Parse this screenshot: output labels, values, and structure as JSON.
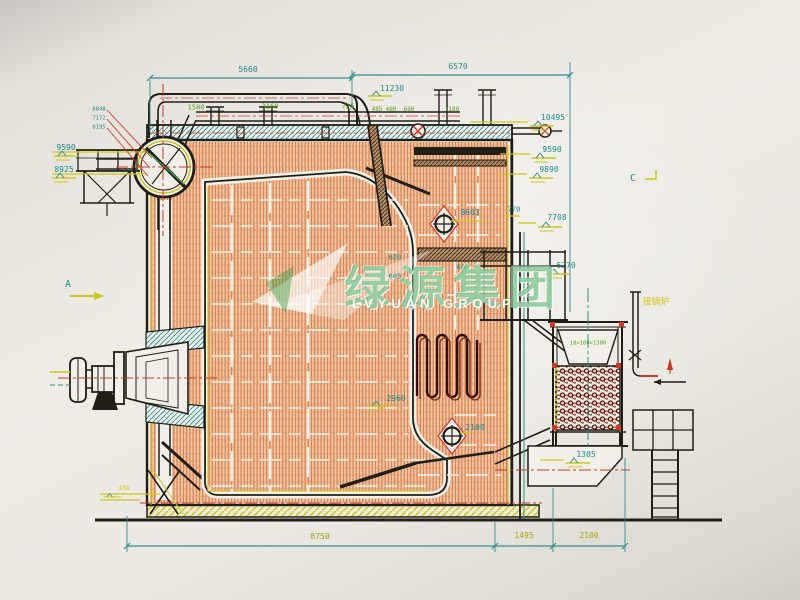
{
  "colors": {
    "paper": "#e9e6e0",
    "ink": "#211e16",
    "teal": "#1f8c8c",
    "green": "#55a11f",
    "yellow": "#cfc51e",
    "olive": "#a49f16",
    "red": "#cc3a28",
    "hatch_orange": "#cf6d3a",
    "dark_red_coil": "#5a140b",
    "watermark_green": "#2fa14b"
  },
  "watermark": {
    "cn": "绿源集团",
    "en": "LVYUAN GROUP"
  },
  "annotations": [
    {
      "id": "dim-5660",
      "text": "5660",
      "x": 248,
      "y": 70,
      "cls": "teal"
    },
    {
      "id": "dim-6570",
      "text": "6570",
      "x": 458,
      "y": 67,
      "cls": "teal"
    },
    {
      "id": "elev-11230",
      "text": "11230",
      "x": 392,
      "y": 89,
      "cls": "teal"
    },
    {
      "id": "dim-1580",
      "text": "1580",
      "x": 196,
      "y": 108,
      "cls": "green"
    },
    {
      "id": "dim-3160",
      "text": "3160",
      "x": 270,
      "y": 107,
      "cls": "green"
    },
    {
      "id": "dim-725",
      "text": "725",
      "x": 348,
      "y": 107,
      "cls": "green"
    },
    {
      "id": "dim-485",
      "text": "485",
      "x": 377,
      "y": 110,
      "cls": "green-sm"
    },
    {
      "id": "dim-480",
      "text": "480",
      "x": 391,
      "y": 110,
      "cls": "green-sm"
    },
    {
      "id": "dim-680",
      "text": "680",
      "x": 409,
      "y": 110,
      "cls": "green-sm"
    },
    {
      "id": "dim-1180",
      "text": "1180",
      "x": 452,
      "y": 110,
      "cls": "green-sm"
    },
    {
      "id": "elev-10495",
      "text": "10495",
      "x": 553,
      "y": 118,
      "cls": "teal"
    },
    {
      "id": "elev-9590-right",
      "text": "9590",
      "x": 552,
      "y": 150,
      "cls": "teal"
    },
    {
      "id": "elev-9890",
      "text": "9890",
      "x": 549,
      "y": 170,
      "cls": "teal"
    },
    {
      "id": "spec-1",
      "text": "8848",
      "x": 99,
      "y": 110,
      "cls": "tiny"
    },
    {
      "id": "spec-2",
      "text": "7172",
      "x": 99,
      "y": 119,
      "cls": "tiny"
    },
    {
      "id": "spec-3",
      "text": "8195",
      "x": 99,
      "y": 128,
      "cls": "tiny"
    },
    {
      "id": "elev-9590-left",
      "text": "9590",
      "x": 66,
      "y": 148,
      "cls": "teal"
    },
    {
      "id": "elev-8925",
      "text": "8925",
      "x": 64,
      "y": 170,
      "cls": "teal"
    },
    {
      "id": "section-a",
      "text": "A",
      "x": 68,
      "y": 285,
      "cls": "teal-lg"
    },
    {
      "id": "section-c",
      "text": "C",
      "x": 633,
      "y": 179,
      "cls": "teal-lg"
    },
    {
      "id": "elev-8603",
      "text": "8603",
      "x": 470,
      "y": 213,
      "cls": "teal"
    },
    {
      "id": "dim-770",
      "text": "770",
      "x": 514,
      "y": 210,
      "cls": "teal-sm"
    },
    {
      "id": "elev-7708",
      "text": "7708",
      "x": 557,
      "y": 218,
      "cls": "teal"
    },
    {
      "id": "elev-6270",
      "text": "6270",
      "x": 566,
      "y": 266,
      "cls": "teal"
    },
    {
      "id": "dim-620",
      "text": "620",
      "x": 395,
      "y": 258,
      "cls": "teal-sm"
    },
    {
      "id": "dim-605",
      "text": "605",
      "x": 395,
      "y": 277,
      "cls": "teal-sm"
    },
    {
      "id": "dim-600",
      "text": "600",
      "x": 463,
      "y": 268,
      "cls": "teal-sm"
    },
    {
      "id": "elev-2960",
      "text": "2960",
      "x": 396,
      "y": 399,
      "cls": "teal"
    },
    {
      "id": "elev-2100-target",
      "text": "2100",
      "x": 475,
      "y": 428,
      "cls": "teal"
    },
    {
      "id": "elev-1305",
      "text": "1305",
      "x": 586,
      "y": 455,
      "cls": "teal"
    },
    {
      "id": "dim-8750",
      "text": "8750",
      "x": 320,
      "y": 537,
      "cls": "olive"
    },
    {
      "id": "dim-1495",
      "text": "1495",
      "x": 524,
      "y": 536,
      "cls": "olive"
    },
    {
      "id": "dim-2100-bottom",
      "text": "2100",
      "x": 589,
      "y": 536,
      "cls": "olive"
    },
    {
      "id": "elev-438",
      "text": "438",
      "x": 124,
      "y": 489,
      "cls": "yellow-sm"
    },
    {
      "id": "spec-hopper",
      "text": "18×100×1300",
      "x": 588,
      "y": 344,
      "cls": "green-xs"
    },
    {
      "id": "note-chinese",
      "text": "接锅炉",
      "x": 656,
      "y": 303,
      "cls": "yellow-cn"
    }
  ]
}
